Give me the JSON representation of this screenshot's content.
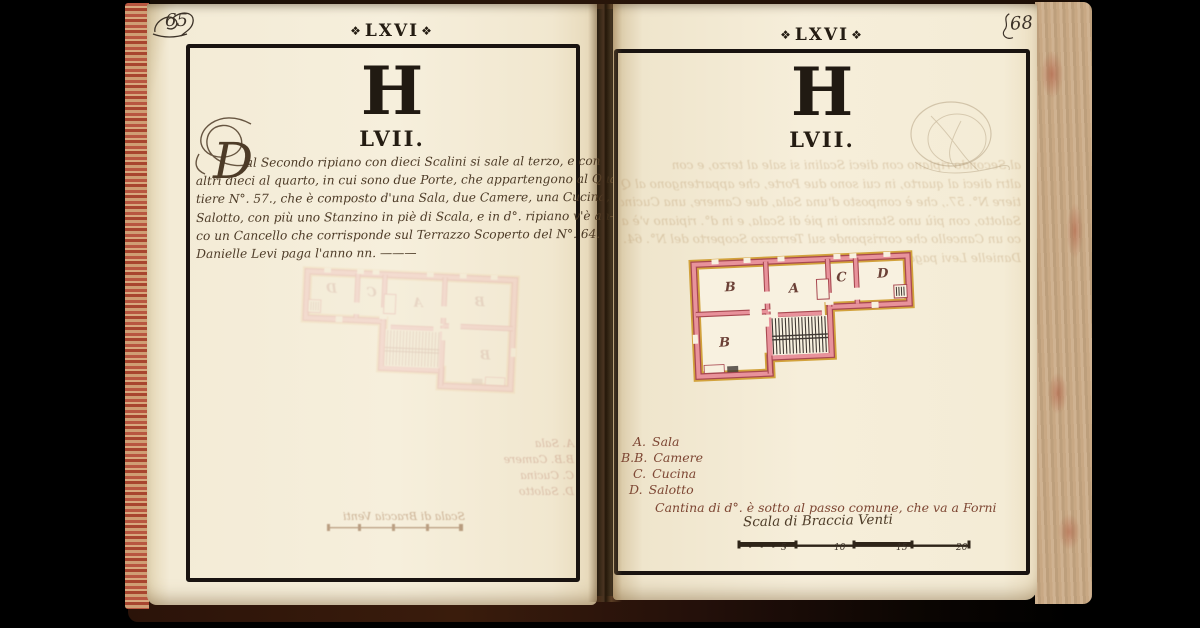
{
  "ornament": "❖",
  "page_left": {
    "folio_mark": "65",
    "header": "LXVI",
    "letter": "H",
    "number": "LVII.",
    "initial": "D",
    "text_lines": [
      "al Secondo ripiano con dieci Scalini si sale al terzo, e con",
      "altri dieci al quarto, in cui sono due Porte, che appartengono al Quar-",
      "tiere N°. 57., che è composto d'una Sala, due Camere, una Cucina, e",
      "Salotto, con più uno Stanzino in piè di Scala, e in d°. ripiano v'è an-",
      "co un Cancello che corrisponde sul Terrazzo Scoperto del N°. 64.",
      "Danielle Levi paga l'anno nn. ———"
    ]
  },
  "page_right": {
    "folio_number": "68",
    "header": "LXVI",
    "letter": "H",
    "number": "LVII.",
    "legend": [
      {
        "key": "A.",
        "label": "Sala"
      },
      {
        "key": "B.B.",
        "label": "Camere"
      },
      {
        "key": "C.",
        "label": "Cucina"
      },
      {
        "key": "D.",
        "label": "Salotto"
      }
    ],
    "legend_note": "Cantina di d°. è sotto al passo comune, che va a Forni",
    "scale_label": "Scala di Braccia Venti",
    "scale_ticks": [
      "5",
      "10",
      "15",
      "20"
    ]
  },
  "plan": {
    "rooms": {
      "a": "A",
      "b_top": "B",
      "b_bottom": "B",
      "c": "C",
      "d": "D"
    }
  },
  "colors": {
    "background": "#000000",
    "paper": "#f5eedb",
    "ink": "#4d3b27",
    "letterpress": "#231c13",
    "plan_wall_fill": "#e8929b",
    "plan_wall_edge": "#a84850",
    "plan_trace": "#d2a23c",
    "legend_ink": "#7d4633"
  }
}
